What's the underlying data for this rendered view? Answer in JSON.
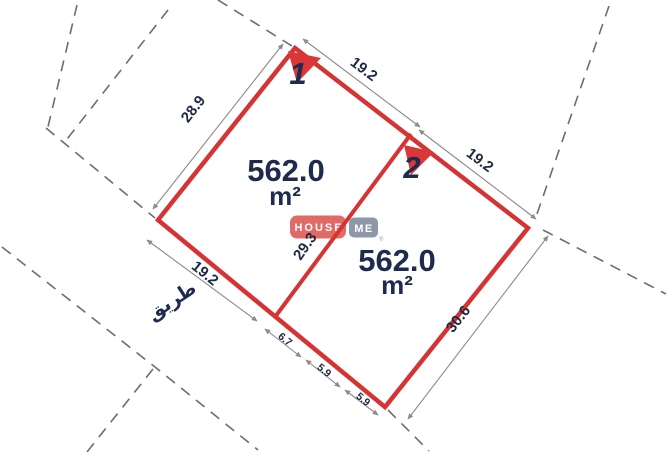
{
  "diagram": {
    "type": "land-plot-subdivision-plan",
    "background": "#ffffff",
    "boundary_color": "#d63434",
    "text_color": "#1e2a4e",
    "dimension_line_color": "#8b8b8b",
    "dashed_line_color": "#6d6d6d"
  },
  "plots": [
    {
      "id": "1",
      "area_value": "562.0",
      "area_unit": "m²"
    },
    {
      "id": "2",
      "area_value": "562.0",
      "area_unit": "m²"
    }
  ],
  "dimensions": {
    "top_left_edge": "28.9",
    "plot1_top_right_edge": "19.2",
    "plot2_top_right_edge": "19.2",
    "division_line": "29.3",
    "plot1_bottom_left_edge": "19.2",
    "bottom_segments": [
      "6.7",
      "5.9",
      "5.9"
    ],
    "bottom_right_edge": "30.6"
  },
  "road_label": "طريق",
  "logo": {
    "part1": "HOUSE",
    "part1_bg": "#e26a66",
    "part2": "ME",
    "part2_bg": "#8d97a7",
    "registered_mark": "®"
  }
}
